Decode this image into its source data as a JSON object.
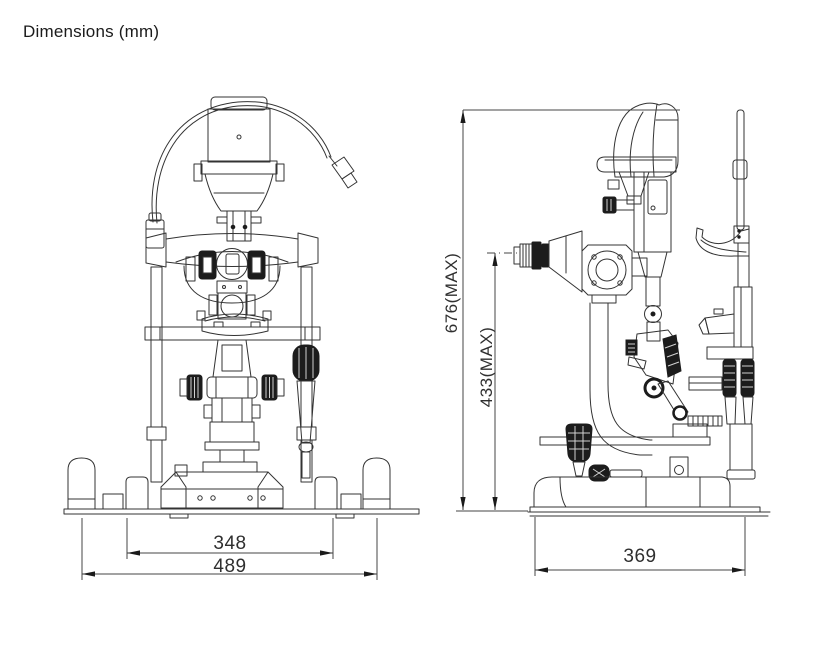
{
  "title": "Dimensions (mm)",
  "figure": {
    "type": "technical-dimension-drawing",
    "subject": "slit-lamp front view and side view line drawings",
    "units": "mm"
  },
  "dimensions": {
    "front_inner_width": "348",
    "front_overall_width": "489",
    "side_overall_depth": "369",
    "overall_height_max": "676(MAX)",
    "eyepiece_height_max": "433(MAX)"
  },
  "colors": {
    "background": "#ffffff",
    "line": "#333333",
    "dark_fill": "#1c1c1c",
    "text": "#2f2f2f"
  }
}
